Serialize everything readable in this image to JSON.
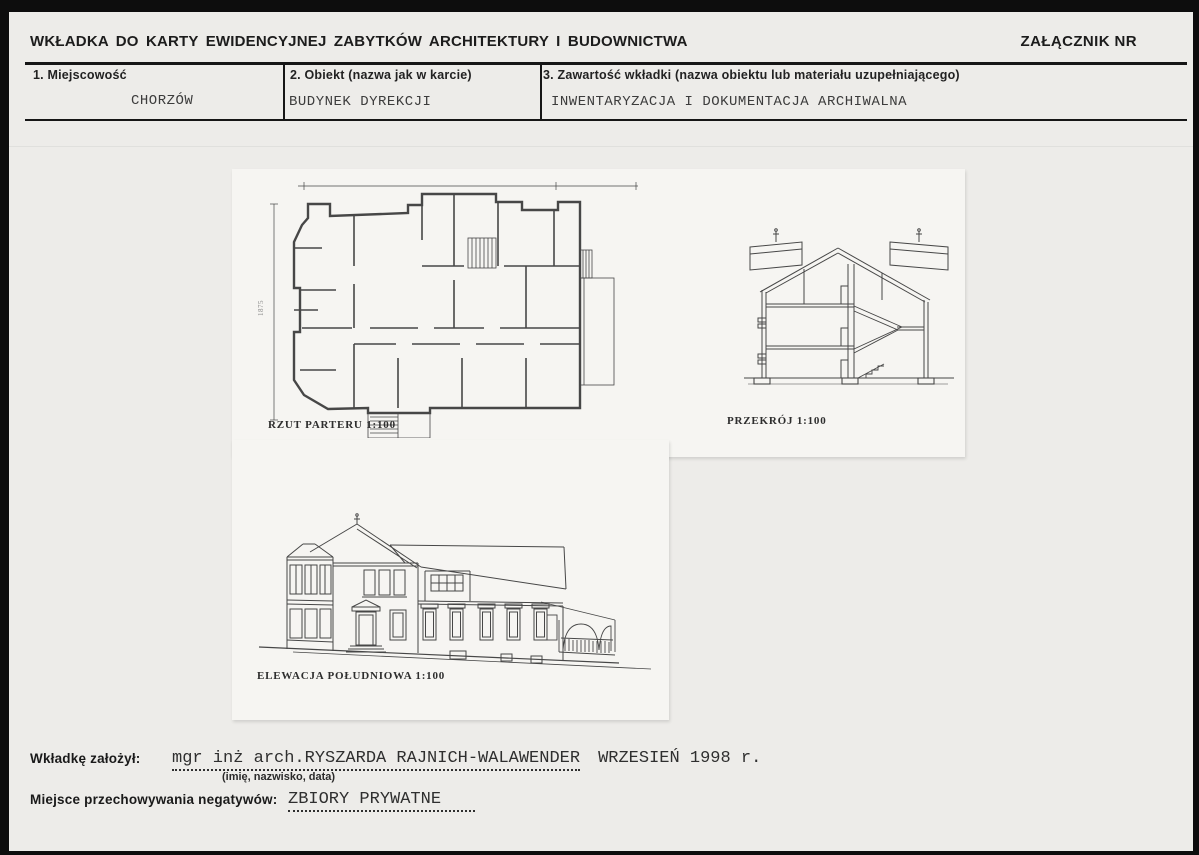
{
  "header": {
    "title": "WKŁADKA DO KARTY EWIDENCYJNEJ ZABYTKÓW ARCHITEKTURY I BUDOWNICTWA",
    "attachment_label": "ZAŁĄCZNIK NR"
  },
  "fields": [
    {
      "label": "1. Miejscowość",
      "value": "CHORZÓW"
    },
    {
      "label": "2. Obiekt (nazwa jak w karcie)",
      "value": "BUDYNEK DYREKCJI"
    },
    {
      "label": "3. Zawartość wkładki (nazwa obiektu lub materiału uzupełniającego)",
      "value": "INWENTARYZACJA I DOKUMENTACJA ARCHIWALNA"
    }
  ],
  "drawings": {
    "plan": {
      "caption": "RZUT PARTERU  1:100",
      "height_dimension": "1875"
    },
    "section": {
      "caption": "PRZEKRÓJ  1:100"
    },
    "elevation": {
      "caption": "ELEWACJA POŁUDNIOWA 1:100"
    }
  },
  "footer": {
    "author_label": "Wkładkę założył:",
    "author_name": "mgr inż arch.RYSZARDA RAJNICH-WALAWENDER",
    "author_date": "WRZESIEŃ 1998 r.",
    "author_hint": "(imię, nazwisko, data)",
    "negatives_label": "Miejsce przechowywania negatywów:",
    "negatives_value": "ZBIORY PRYWATNE"
  }
}
